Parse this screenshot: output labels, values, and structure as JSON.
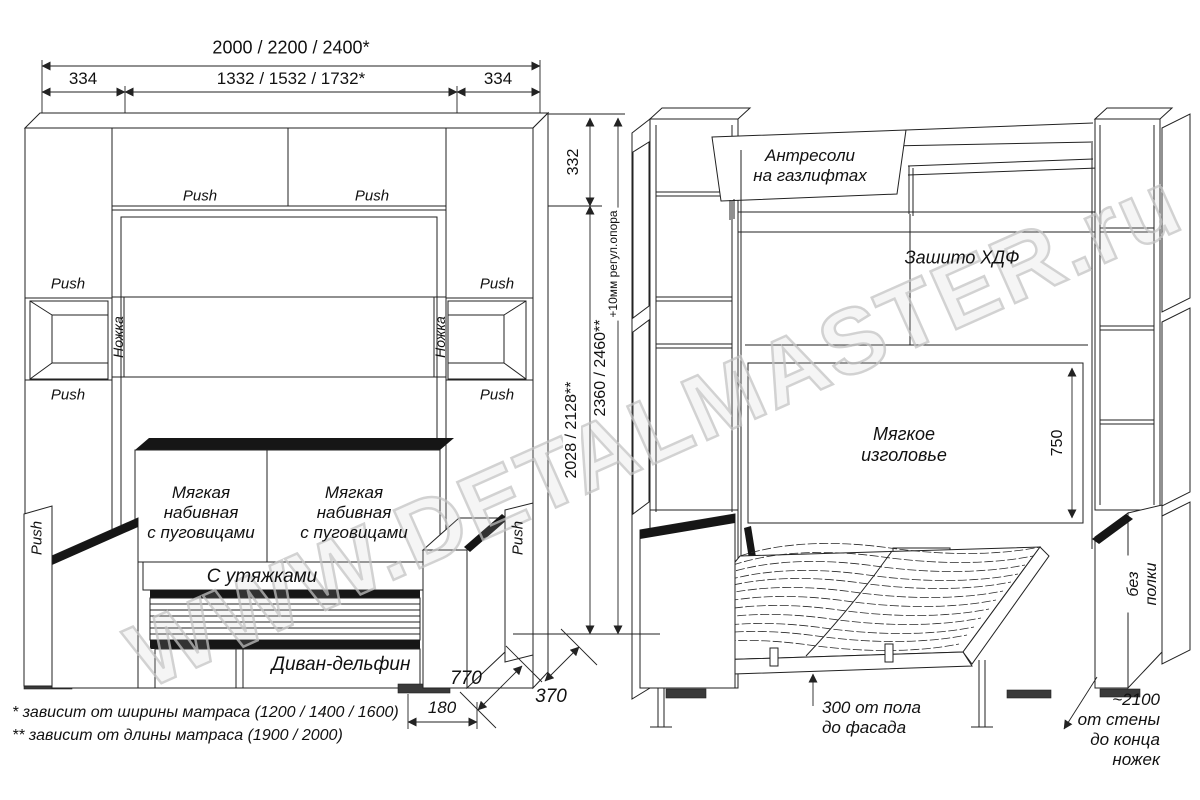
{
  "watermark": "WWW.DETALMASTER.ru",
  "labels": {
    "push": "Push",
    "leg": "Ножка"
  },
  "left_view": {
    "cushion": "Мягкая\nнабивная\nс пуговицами",
    "seat": "С утяжками",
    "sofa_type": "Диван-дельфин"
  },
  "right_view": {
    "antresol": "Антресоли\nна газлифтах",
    "back_panel": "Зашито ХДФ",
    "headboard": "Мягкое\nизголовье",
    "headboard_height": "750",
    "no_shelf": "без полки",
    "floor_clearance": "300 от пола\nдо фасада",
    "wall_distance": "~2100\nот стены\nдо конца ножек"
  },
  "dimensions": {
    "overall_width": "2000 / 2200 / 2400*",
    "side_width_left": "334",
    "inner_width": "1332 / 1532 / 1732*",
    "side_width_right": "334",
    "top_height": "332",
    "inner_height": "2028 / 2128**",
    "total_height": "2360 / 2460**",
    "adjuster": "+10мм регул.опора",
    "sofa_depth": "770",
    "cabinet_depth": "370",
    "base_depth": "180"
  },
  "footnotes": {
    "width_note": "* зависит от ширины матраса (1200 / 1400 / 1600)",
    "length_note": "** зависит от длины матраса (1900 / 2000)"
  }
}
